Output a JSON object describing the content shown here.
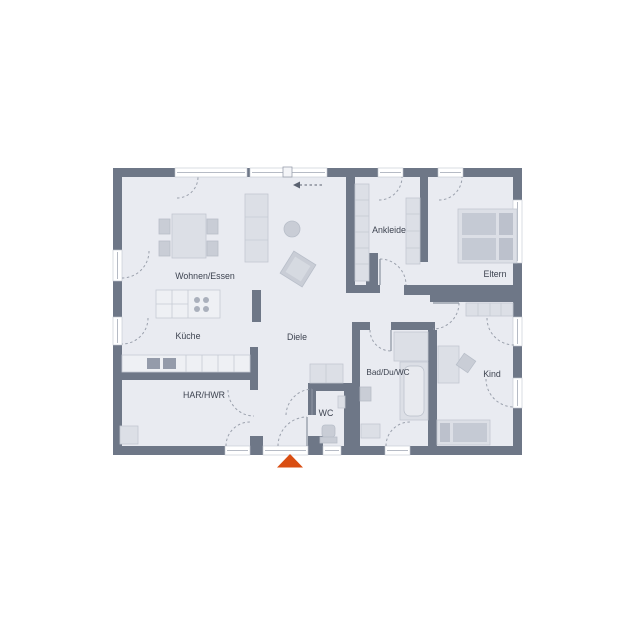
{
  "floorplan": {
    "title": "Bungalow Grundriss",
    "rooms": {
      "wohnen_essen": "Wohnen/Essen",
      "kueche": "Küche",
      "diele": "Diele",
      "ankleide": "Ankleide",
      "eltern": "Eltern",
      "kind": "Kind",
      "bad": "Bad/Du/WC",
      "wc": "WC",
      "har_hwr": "HAR/HWR"
    },
    "colors": {
      "wall": "#6e7787",
      "floor": "#e9ebf1",
      "furniture": "#c9cdd6",
      "entrance_marker": "#d94e12",
      "label_text": "#3d4350"
    },
    "markers": {
      "entrance_arrow": "entrance-triangle",
      "sliding_door_arrow": "slide-direction-left"
    }
  }
}
